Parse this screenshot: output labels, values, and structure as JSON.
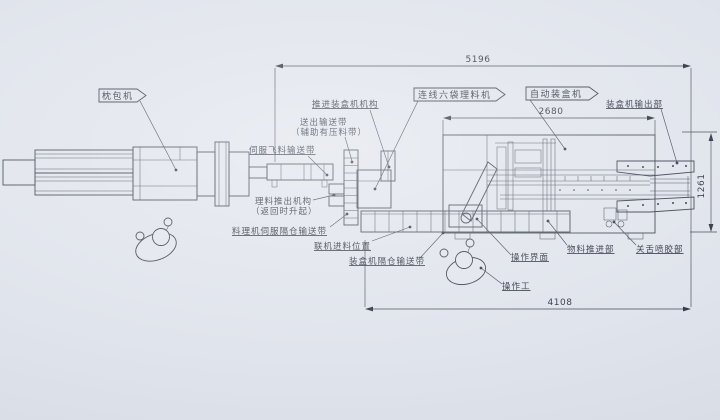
{
  "drawing": {
    "machines": {
      "pillow_packer": {
        "label": "枕包机"
      },
      "inline_collator": {
        "label": "连线六袋理料机"
      },
      "auto_cartoner": {
        "label": "自动装盒机"
      }
    },
    "callouts": {
      "push_into_cartoner": "推进装盒机机构",
      "outfeed_belt": "送出输送带",
      "outfeed_belt_note": "（辅助有压料带）",
      "servo_fly_belt": "伺服飞料输送带",
      "collator_pushout": "理料推出机构",
      "collator_pushout_note": "（返回时升起）",
      "collator_servo_belt": "料理机伺服隔仓输送带",
      "inline_feed_position": "联机进料位置",
      "cartoner_pocket_belt": "装盒机隔仓输送带",
      "cartoner_outlet": "装盒机输出部",
      "material_pusher": "物料推进部",
      "tongue_glue_unit": "关舌喷胶部",
      "operator_panel": "操作界面",
      "operator_person": "操作工"
    },
    "dimensions": {
      "overall_length": "5196",
      "cartoner_length": "2680",
      "line_length": "4108",
      "machine_width": "1261"
    },
    "colors": {
      "paper": "#e0e4ec",
      "ink": "#3f4654"
    }
  }
}
